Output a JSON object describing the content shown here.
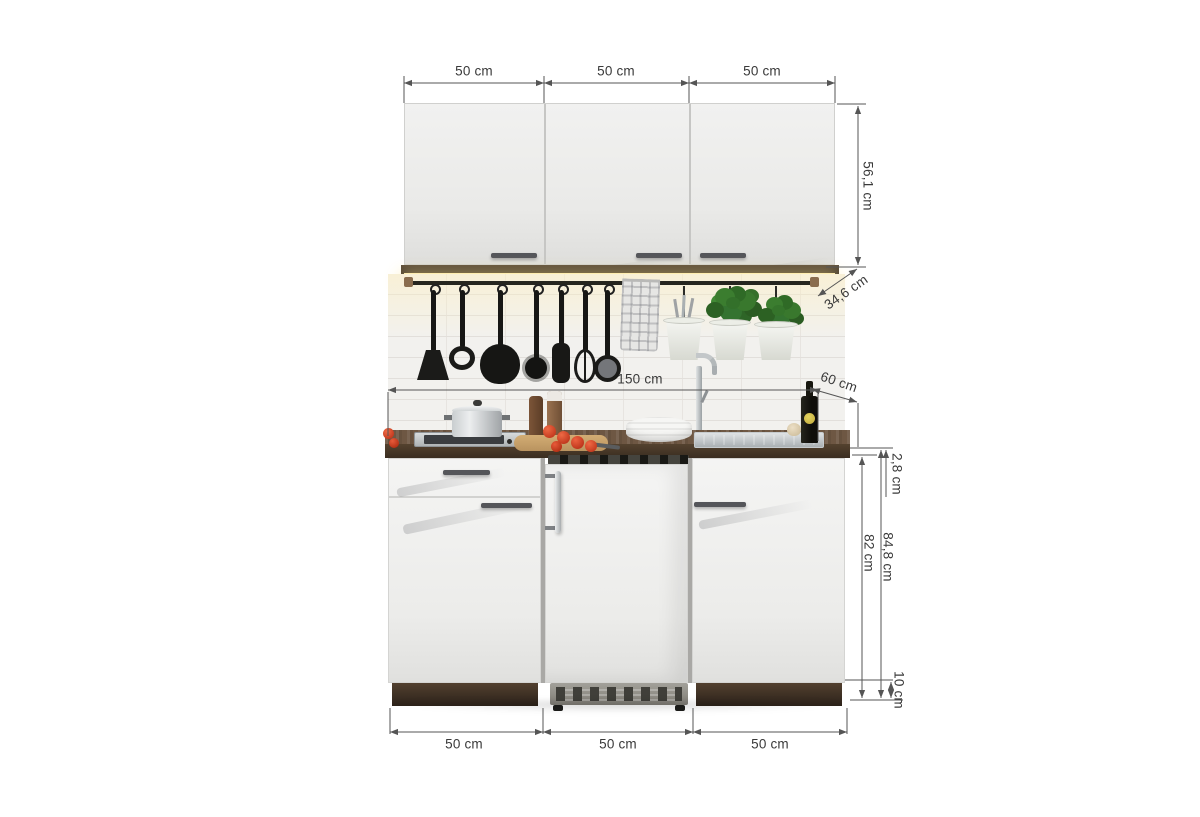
{
  "labels": {
    "top_widths": [
      "50 cm",
      "50 cm",
      "50 cm"
    ],
    "bottom_widths": [
      "50 cm",
      "50 cm",
      "50 cm"
    ],
    "wall_cabinet_height": "56,1 cm",
    "wall_cabinet_depth": "34,6 cm",
    "total_width": "150 cm",
    "worktop_depth": "60 cm",
    "worktop_thickness": "2,8 cm",
    "base_height_total": "84,8 cm",
    "base_height_body": "82 cm",
    "plinth_height": "10 cm"
  },
  "colors": {
    "dimension_line": "#555555",
    "label_text": "#3a3a3a",
    "cabinet_front": "#efefee",
    "wood_dark": "#46362a",
    "worktop_wood": "#6e5743",
    "led_glow": "#ffedb0",
    "stainless": "#c3c7c9",
    "plant_green": "#3a7a2e",
    "tomato_red": "#cf3420",
    "background": "#ffffff"
  }
}
